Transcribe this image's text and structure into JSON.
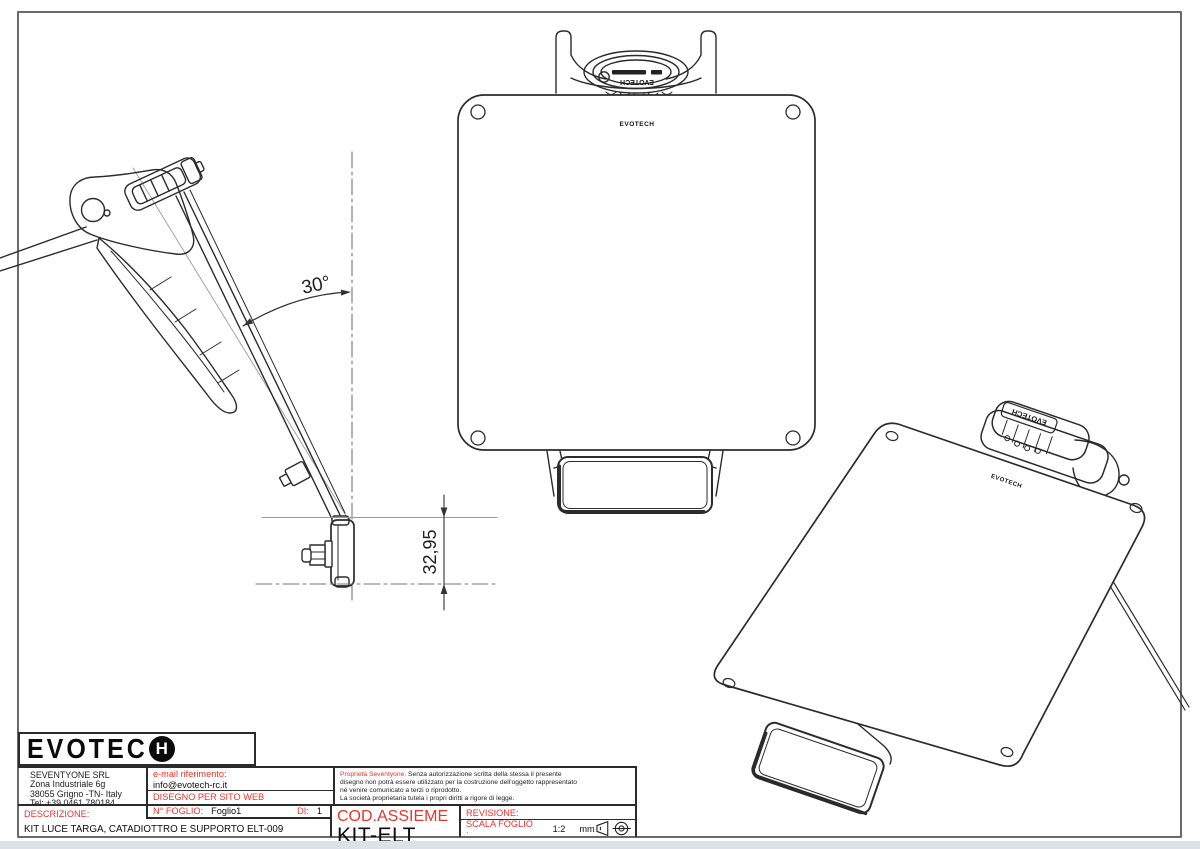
{
  "brand": {
    "name": "EVOTECH",
    "logo_part1": "EVOTEC",
    "logo_part2": "H"
  },
  "dims": {
    "angle": "30°",
    "height": "32,95"
  },
  "title_block": {
    "company": {
      "name": "SEVENTYONE SRL",
      "address_line1": "Zona Industriale 6g",
      "address_line2": "38055 Grigno -TN- Italy",
      "phone": "Tel: +39 0461 780184"
    },
    "email_label": "e-mail riferimento:",
    "email_value": "info@evotech-rc.it",
    "drawing_purpose": "DISEGNO PER SITO WEB",
    "proprietary_lead": "Proprietà Seventyone.",
    "proprietary_line1": "Senza autorizzazione scritta della stessa il presente",
    "proprietary_line2": "disegno non potrà essere utilizzato per la costruzione dell'oggetto rappresentato",
    "proprietary_line3": "né venire comunicato a terzi o riprodotto.",
    "proprietary_line4": "La società proprietaria tutela i propri diritti a rigore di legge.",
    "descrizione_label": "DESCRIZIONE:",
    "descrizione_value": "KIT LUCE TARGA, CATADIOTTRO E SUPPORTO ELT-009",
    "foglio_label": "N° FOGLIO:",
    "foglio_value": "Foglio1",
    "di_label": "DI:",
    "di_value": "1",
    "cod_assieme_label": "COD.ASSIEME",
    "cod_assieme_value": "KIT-ELT",
    "revisione_label": "REVISIONE:",
    "scala_label": "SCALA FOGLIO :",
    "scala_value": "1:2",
    "scala_unit": "mm"
  },
  "colors": {
    "accent_red": "#e8352c",
    "line_dark": "#2b2b2b",
    "frame_gray": "#6a6a6a",
    "footer_strip": "#dde2e9"
  }
}
